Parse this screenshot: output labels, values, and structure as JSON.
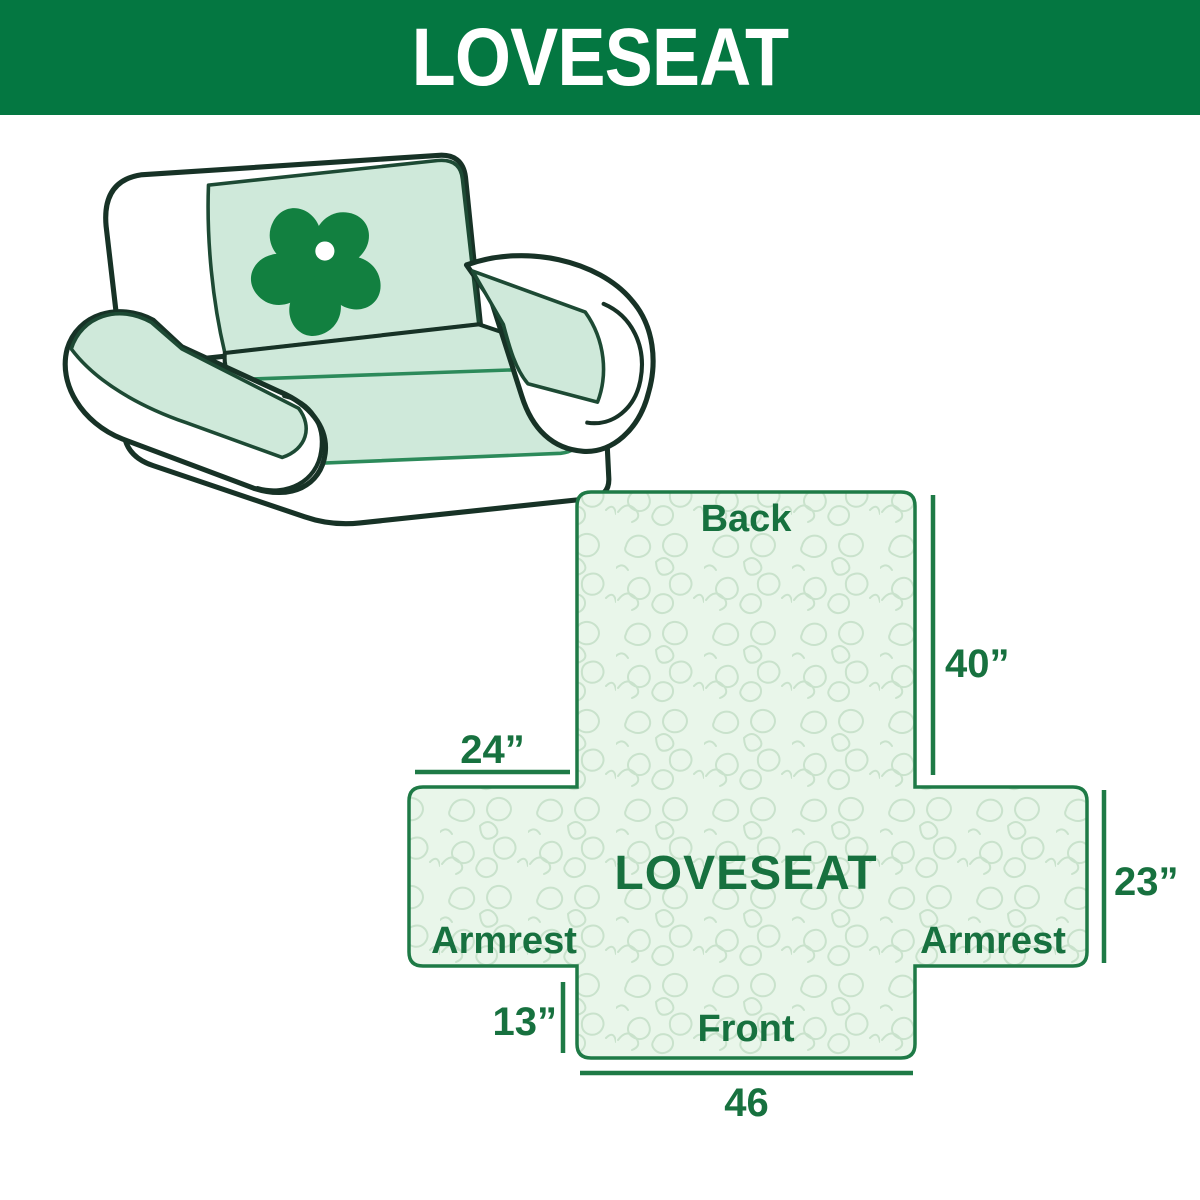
{
  "header": {
    "title": "LOVESEAT"
  },
  "illustration": {
    "name": "loveseat-with-slipcover",
    "logo_icon": "pinwheel-icon"
  },
  "diagram": {
    "sections": {
      "back": "Back",
      "center": "LOVESEAT",
      "armrest_left": "Armrest",
      "armrest_right": "Armrest",
      "front": "Front"
    },
    "dimensions": {
      "back_height": "40”",
      "armrest_top_width": "24”",
      "armrest_side_height": "23”",
      "front_skirt_height": "13”",
      "front_width": "46"
    }
  },
  "colors": {
    "header_bg": "#047741",
    "accent_text": "#17713F",
    "diagram_outline": "#1E7A46",
    "diagram_fill": "#E9F6EA",
    "texture_line": "#C9E2CC",
    "cover_mint": "#CFE9DA",
    "logo_green": "#128040",
    "sofa_outline": "#173226"
  }
}
